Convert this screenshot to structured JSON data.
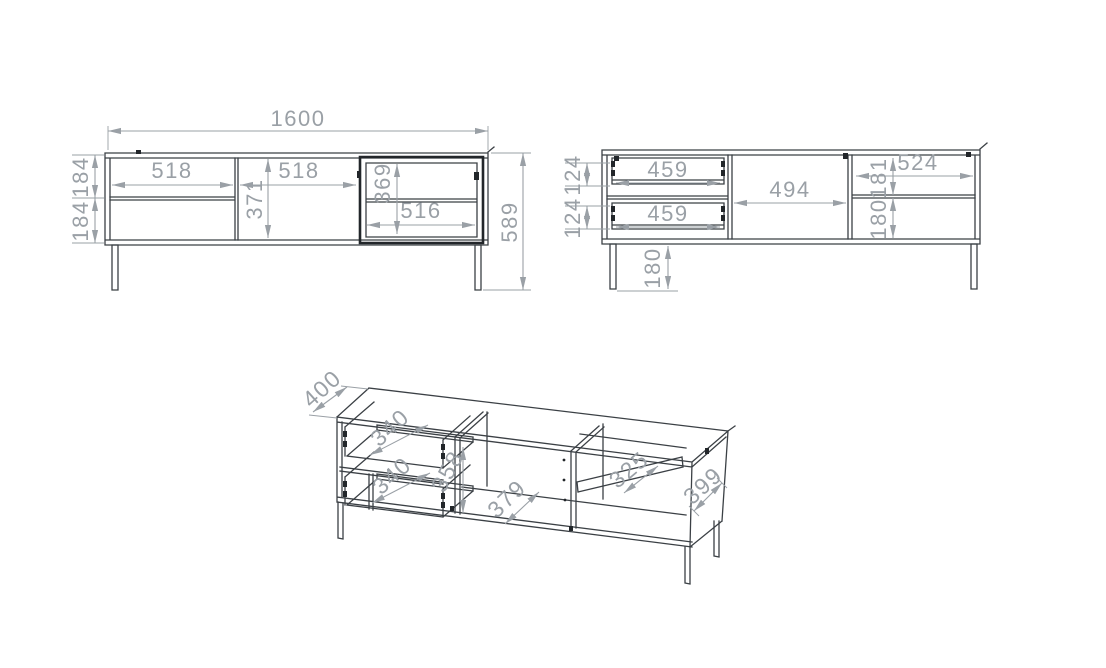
{
  "drawing": {
    "title": "tv-stand-dimension-drawing",
    "colors": {
      "line": "#3b4045",
      "dim": "#9aa0a6",
      "background": "#ffffff"
    },
    "views": {
      "front_exterior": {
        "total_width_mm": "1600",
        "total_height_mm": "589",
        "left_drawer_height_top_mm": "184",
        "left_drawer_height_bottom_mm": "184",
        "left_section_width_mm": "518",
        "middle_door_width_mm": "518",
        "middle_door_height_mm": "371",
        "glass_door_height_mm": "369",
        "glass_door_width_mm": "516"
      },
      "front_interior": {
        "drawer_front_height_top_mm": "124",
        "drawer_front_height_bottom_mm": "124",
        "drawer_width_top_mm": "459",
        "drawer_width_bottom_mm": "459",
        "middle_compartment_width_mm": "494",
        "right_compartment_width_mm": "524",
        "right_upper_height_mm": "181",
        "right_lower_height_mm": "180",
        "leg_height_mm": "180"
      },
      "isometric": {
        "top_depth_mm": "400",
        "top_drawer_depth_mm": "340",
        "bottom_drawer_depth_mm": "340",
        "partition_height_mm": "358",
        "bottom_depth_mm": "379",
        "shelf_depth_mm": "325",
        "side_depth_mm": "399"
      }
    }
  }
}
